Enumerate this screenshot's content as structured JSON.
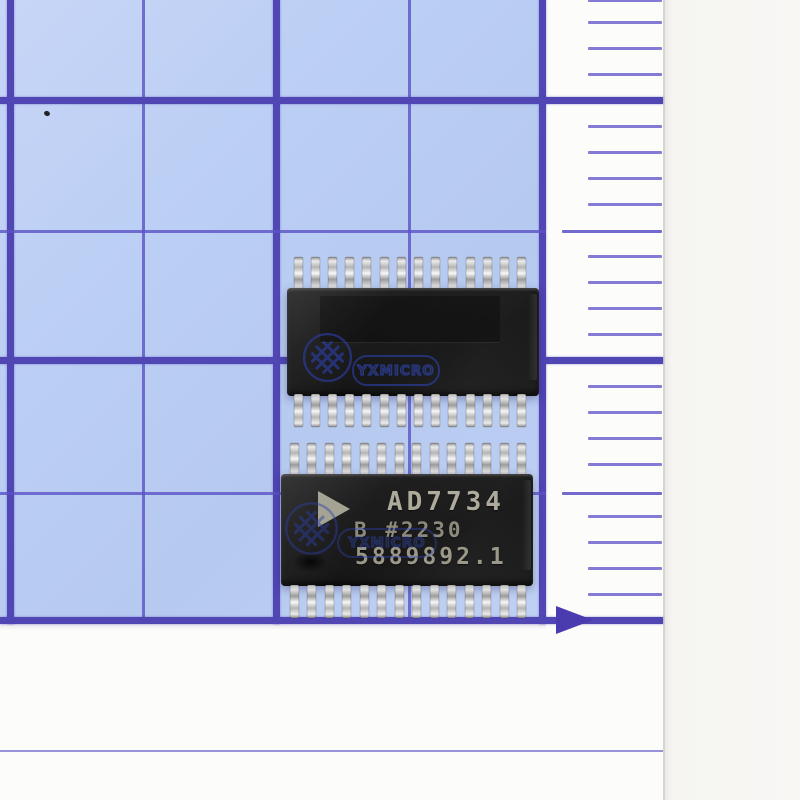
{
  "paper": {
    "type_label": "blue-grid-graph-paper",
    "paper_color": "#bccff4",
    "grid_color": "#5046b4",
    "tick_color": "#6e64cd",
    "ruler": {
      "arrow_icon": "right-arrow-icon",
      "minor_ticks_per_major_division": 10
    }
  },
  "chips": {
    "top": {
      "orientation": "back-side-up",
      "pins_per_side": 14,
      "watermark": {
        "icon": "knot-circle-icon",
        "text": "YXMICRO"
      }
    },
    "bottom": {
      "orientation": "front-side-up",
      "pins_per_side": 14,
      "logo_icon": "analog-devices-triangle-icon",
      "marking_line1": "AD7734",
      "marking_line2": "B #2230",
      "marking_line3": "5889892.1",
      "watermark": {
        "icon": "knot-circle-icon",
        "text": "YXMICRO"
      }
    }
  }
}
